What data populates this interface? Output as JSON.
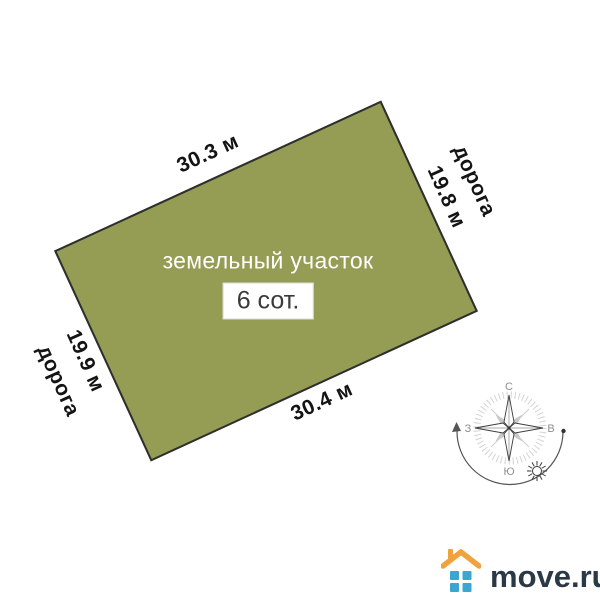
{
  "plot": {
    "label": "земельный участок",
    "area_label": "6 сот.",
    "fill_color": "#949d53",
    "border_color": "#2e2e2e",
    "sides": {
      "top": {
        "length": "30.3 м"
      },
      "right": {
        "length": "19.8 м",
        "road": "дорога"
      },
      "bottom": {
        "length": "30.4 м"
      },
      "left": {
        "length": "19.9 м",
        "road": "дорога"
      }
    }
  },
  "compass": {
    "north": "С",
    "east": "В",
    "south": "Ю",
    "west": "З"
  },
  "logo": {
    "text": "move.ru",
    "colors": {
      "roof": "#f0a23d",
      "squares": "#3aa7d2",
      "text": "#2b3947"
    }
  },
  "icons": {
    "compass": "compass-rose-icon",
    "sun": "sun-icon",
    "house": "house-icon"
  }
}
